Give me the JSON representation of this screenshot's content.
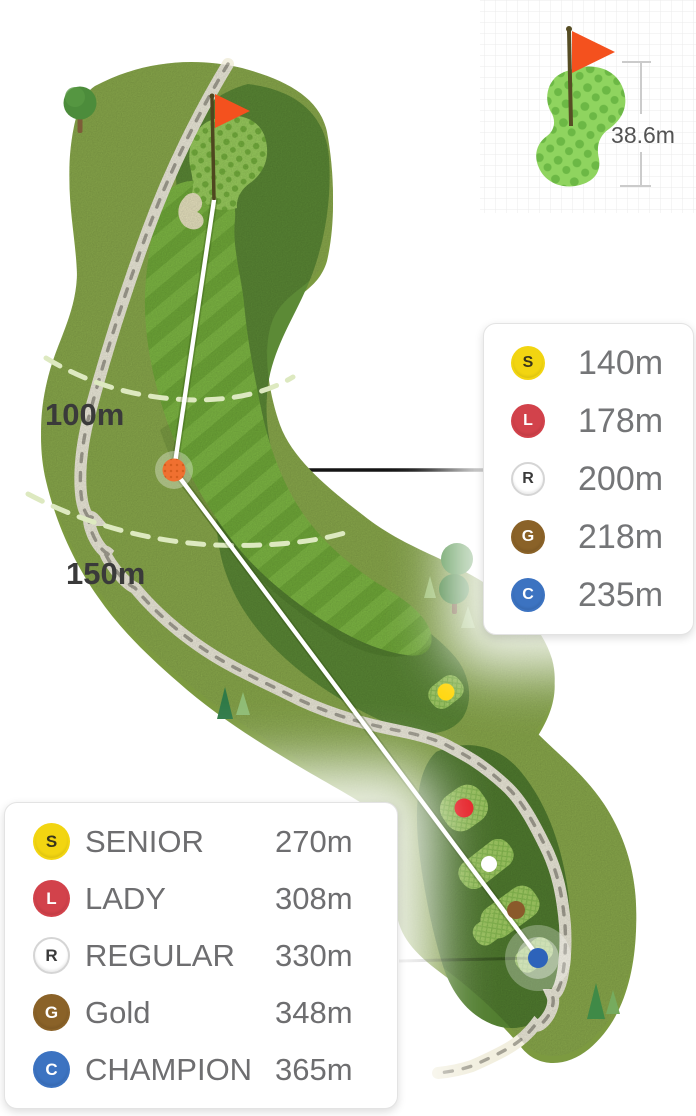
{
  "inset": {
    "measurement": "38.6m"
  },
  "map": {
    "arc_labels": [
      {
        "text": "100m"
      },
      {
        "text": "150m"
      }
    ],
    "markers": {
      "ball_color": "#F07030",
      "senior_color": "#FFD60A",
      "lady_color": "#E51E25",
      "regular_color": "#FFFFFF",
      "gold_color": "#8A5A2B",
      "champion_color": "#2D63BA"
    },
    "flag_color": "#F4511E"
  },
  "palette": {
    "rough": "#8CAC4D",
    "rough_rim": "#7C9A40",
    "deep_rough": "#5C8A36",
    "tee_area": "#527E30",
    "green_base": "#9CD05F",
    "sand": "#ECE7C3",
    "cart_path": "#F2EFDF",
    "path_dash": "#A5A295",
    "arc_dash": "#DDE9C0",
    "shot_line": "#FFFFFF"
  },
  "legend_right": {
    "rows": [
      {
        "letter": "S",
        "value": "140m",
        "circle_color": "#F2D511",
        "letter_color": "#38351C"
      },
      {
        "letter": "L",
        "value": "178m",
        "circle_color": "#D2424B",
        "letter_color": "#FFFFFF"
      },
      {
        "letter": "R",
        "value": "200m",
        "circle_color": "#FFFFFF",
        "letter_color": "#3A3A3A",
        "border_color": "#D5D5D5"
      },
      {
        "letter": "G",
        "value": "218m",
        "circle_color": "#8A6228",
        "letter_color": "#FFFFFF"
      },
      {
        "letter": "C",
        "value": "235m",
        "circle_color": "#3C73C1",
        "letter_color": "#FFFFFF"
      }
    ]
  },
  "legend_bottom": {
    "rows": [
      {
        "letter": "S",
        "label": "SENIOR",
        "value": "270m",
        "circle_color": "#F2D511",
        "letter_color": "#38351C"
      },
      {
        "letter": "L",
        "label": "LADY",
        "value": "308m",
        "circle_color": "#D2424B",
        "letter_color": "#FFFFFF"
      },
      {
        "letter": "R",
        "label": "REGULAR",
        "value": "330m",
        "circle_color": "#FFFFFF",
        "letter_color": "#3A3A3A",
        "border_color": "#D5D5D5"
      },
      {
        "letter": "G",
        "label": "Gold",
        "value": "348m",
        "circle_color": "#8A6228",
        "letter_color": "#FFFFFF"
      },
      {
        "letter": "C",
        "label": "CHAMPION",
        "value": "365m",
        "circle_color": "#3C73C1",
        "letter_color": "#FFFFFF"
      }
    ]
  }
}
